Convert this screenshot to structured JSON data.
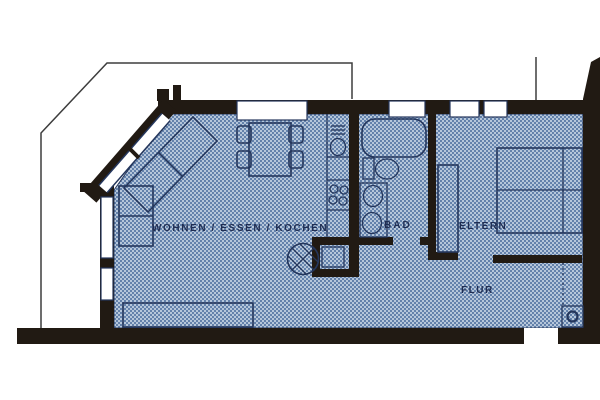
{
  "floorplan": {
    "room_labels": {
      "living": "WOHNEN / ESSEN / KOCHEN",
      "bath": "BAD",
      "parents": "ELTERN",
      "hall": "FLUR"
    },
    "colors": {
      "background": "#ffffff",
      "wall": "#211a13",
      "floor_base": "#9db2cd",
      "floor_dot_dark": "#5e7da8",
      "floor_dot_light": "#c9d6e5",
      "furniture_line": "#24365c",
      "label_text": "#1f2d52",
      "window": "#ffffff",
      "terrace_outline": "#3d3d3d"
    },
    "symbols": [
      "terrace-boundary-line",
      "window-openings",
      "corner-sofa",
      "dining-table",
      "dining-chairs",
      "sideboard",
      "kitchen-sink",
      "stove-burners",
      "hatched-circle-symbol",
      "duct-closet",
      "bathtub",
      "toilet",
      "washbasin",
      "double-bed",
      "wardrobe",
      "hall-closet-dashed",
      "meter-circle-symbol",
      "entrance-door-opening"
    ]
  }
}
